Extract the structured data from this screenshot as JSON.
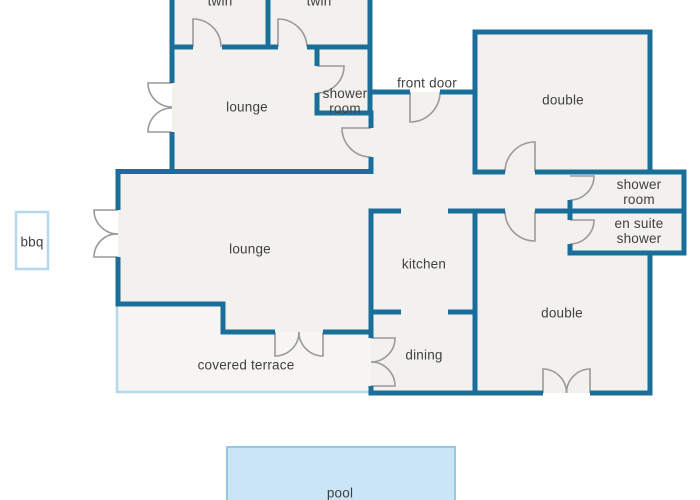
{
  "title": "villa floor plan",
  "colors": {
    "wall": "#1b6e99",
    "floor": "#f2f1ed",
    "terrace_floor": "#f6f5f2",
    "accent_light_blue": "#b5d9ec",
    "pool_fill": "#c9e5f6",
    "pool_border": "#96c8e4",
    "door_arc": "#9a9a9a",
    "label_text": "#404040",
    "background": "#ffffff"
  },
  "labels": {
    "twin_left": "twin",
    "twin_right": "twin",
    "lounge_upper": "lounge",
    "shower_room_top": "shower room",
    "front_door": "front door",
    "double_top": "double",
    "shower_room_right": "shower room",
    "en_suite_shower": "en suite shower",
    "lounge_main": "lounge",
    "kitchen": "kitchen",
    "dining": "dining",
    "covered_terrace": "covered terrace",
    "double_bottom": "double",
    "bbq": "bbq",
    "pool": "pool"
  }
}
